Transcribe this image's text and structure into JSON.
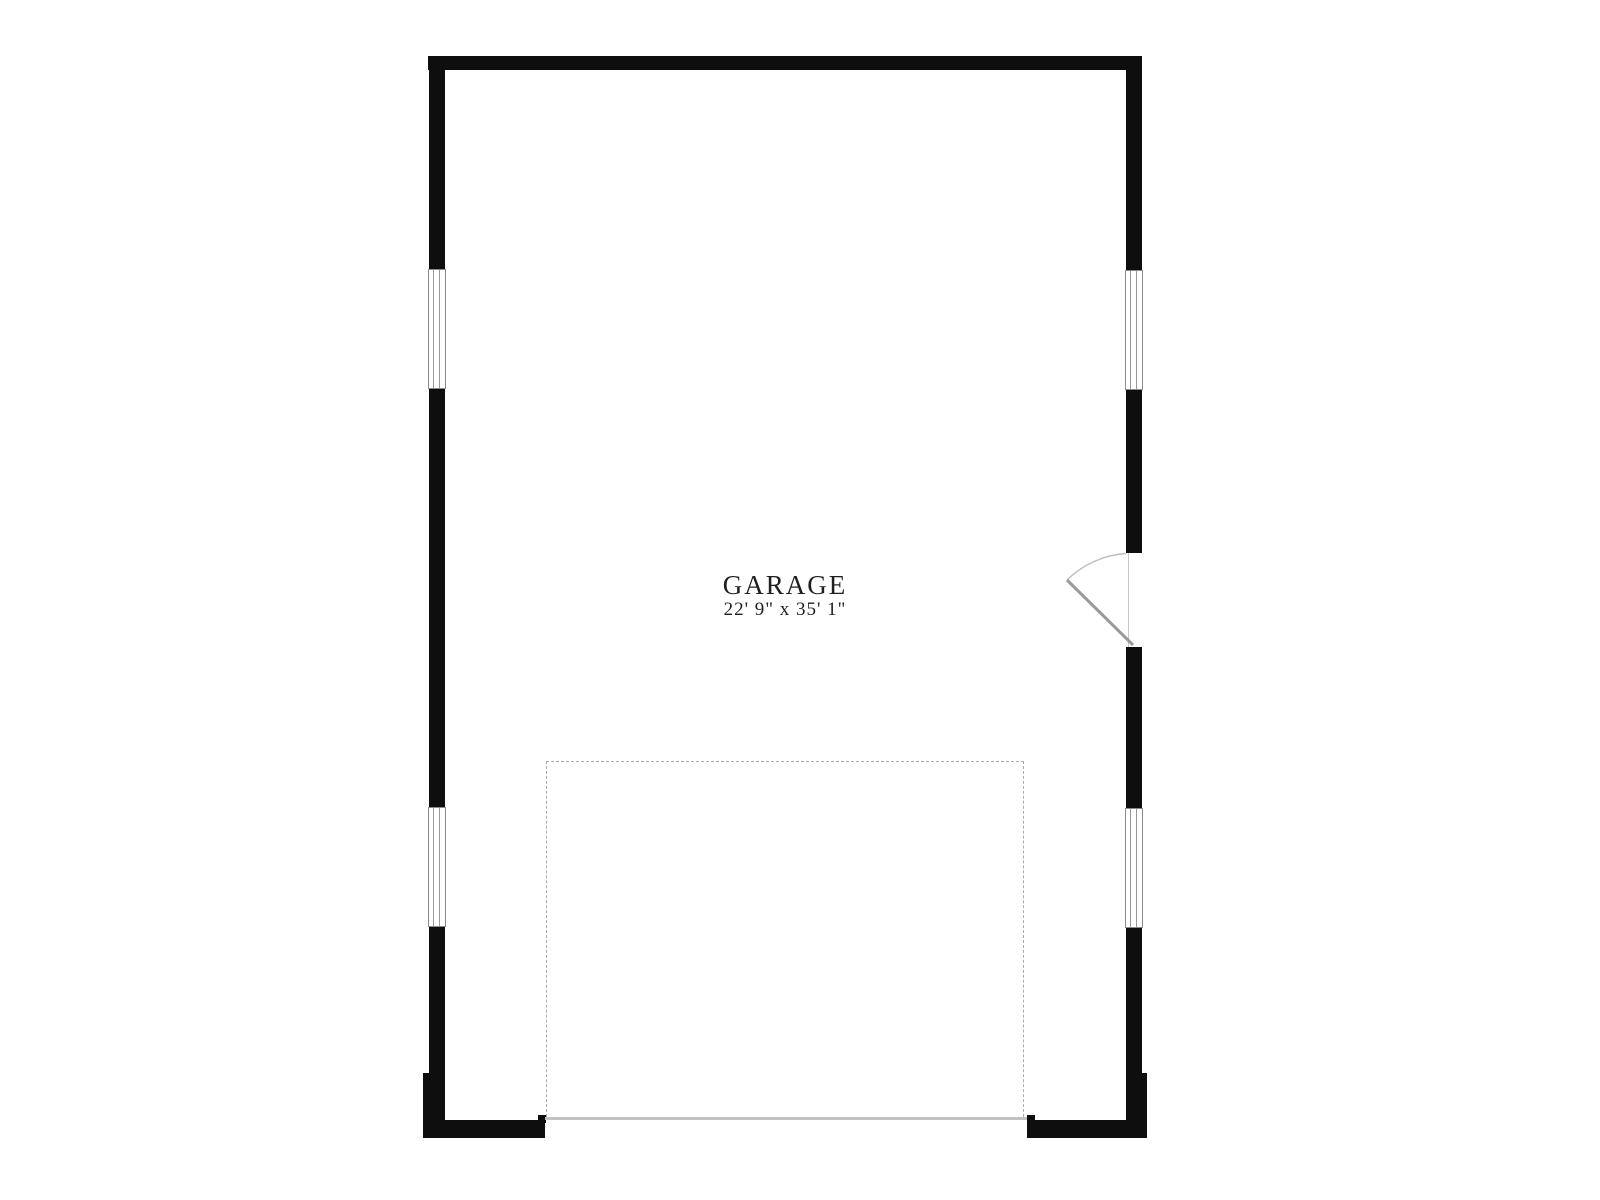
{
  "page": {
    "background_color": "#ffffff"
  },
  "floor_plan": {
    "room": {
      "name": "GARAGE",
      "dimensions": "22' 9\" x 35' 1\""
    },
    "colors": {
      "wall": "#0e0e0e",
      "label_text": "#1f1f1f",
      "window_frame": "#8a8a8a",
      "door_swing_arc": "#bdbdbd",
      "door_leaf": "#9a9a9a",
      "overhead_door_dash": "#ababab",
      "threshold_line": "#c2c2c2"
    },
    "features": {
      "windows": [
        {
          "id": "window-left-upper",
          "wall": "left"
        },
        {
          "id": "window-left-lower",
          "wall": "left"
        },
        {
          "id": "window-right-upper",
          "wall": "right"
        },
        {
          "id": "window-right-lower",
          "wall": "right"
        }
      ],
      "entry_door": {
        "wall": "right",
        "type": "single swing, opens inward"
      },
      "overhead_door": {
        "wall": "bottom",
        "type": "garage overhead door opening",
        "outline": "dashed"
      }
    }
  }
}
